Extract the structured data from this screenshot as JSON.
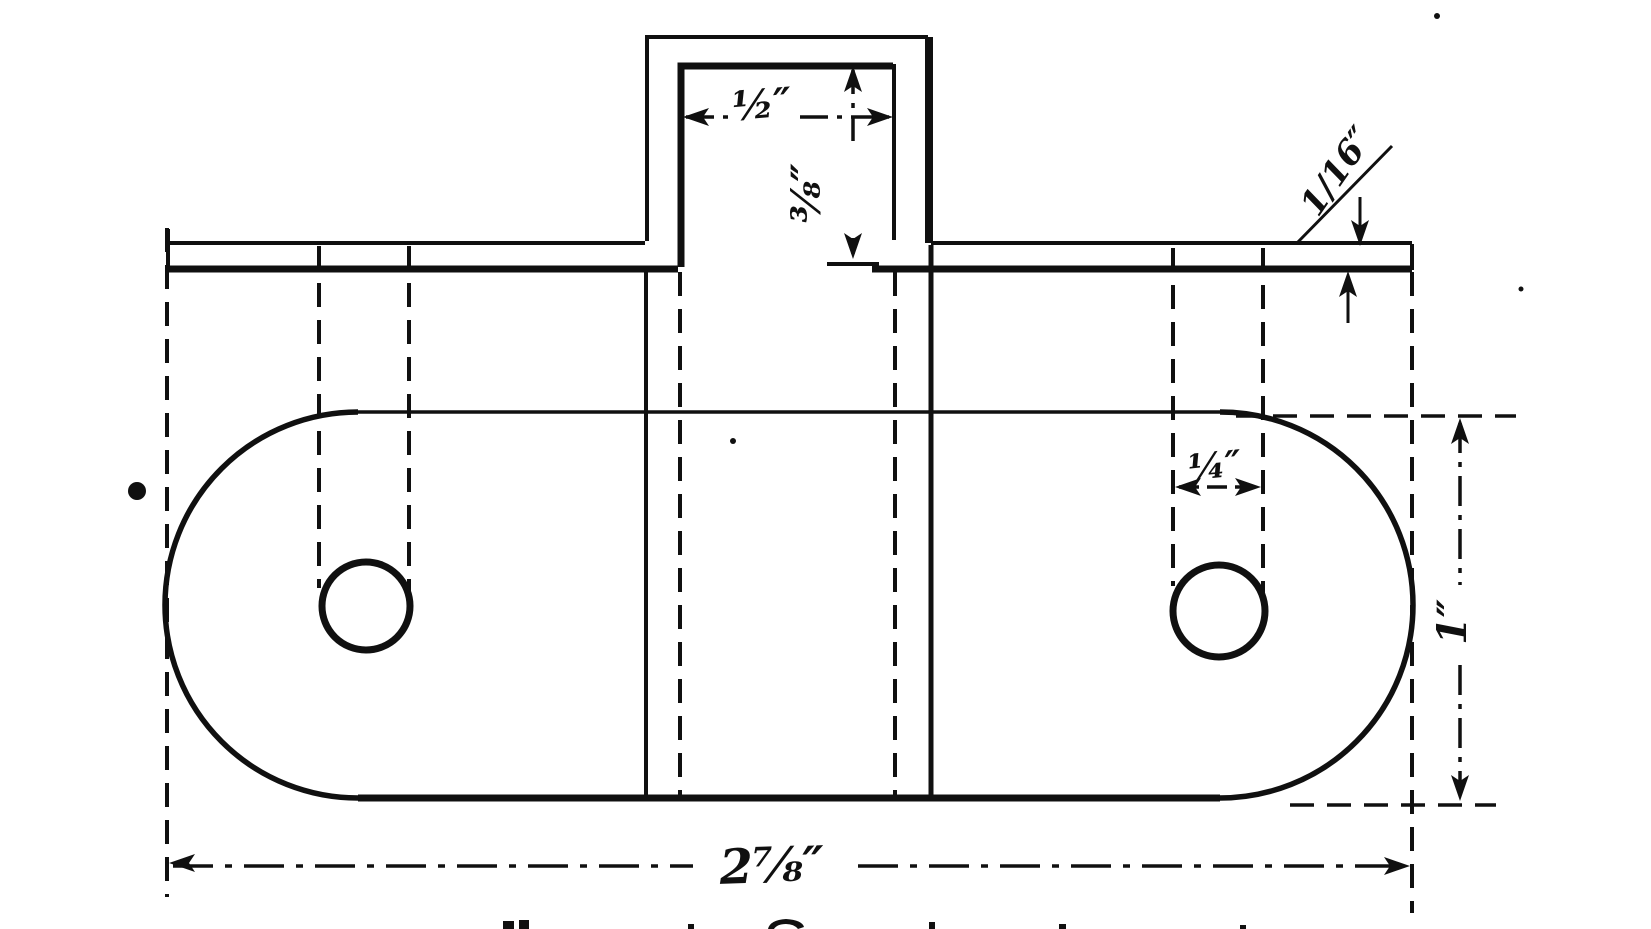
{
  "figure": {
    "title": "Sheet-metal bracket working drawing",
    "ink_color": "#101010",
    "paper_color": "#ffffff"
  },
  "labels": {
    "tab_width": "½″",
    "tab_height": "⅜″",
    "thickness": "1/16″",
    "hole_slot_width": "¼″",
    "plate_depth": "1″",
    "overall_length": "2⅞″"
  }
}
